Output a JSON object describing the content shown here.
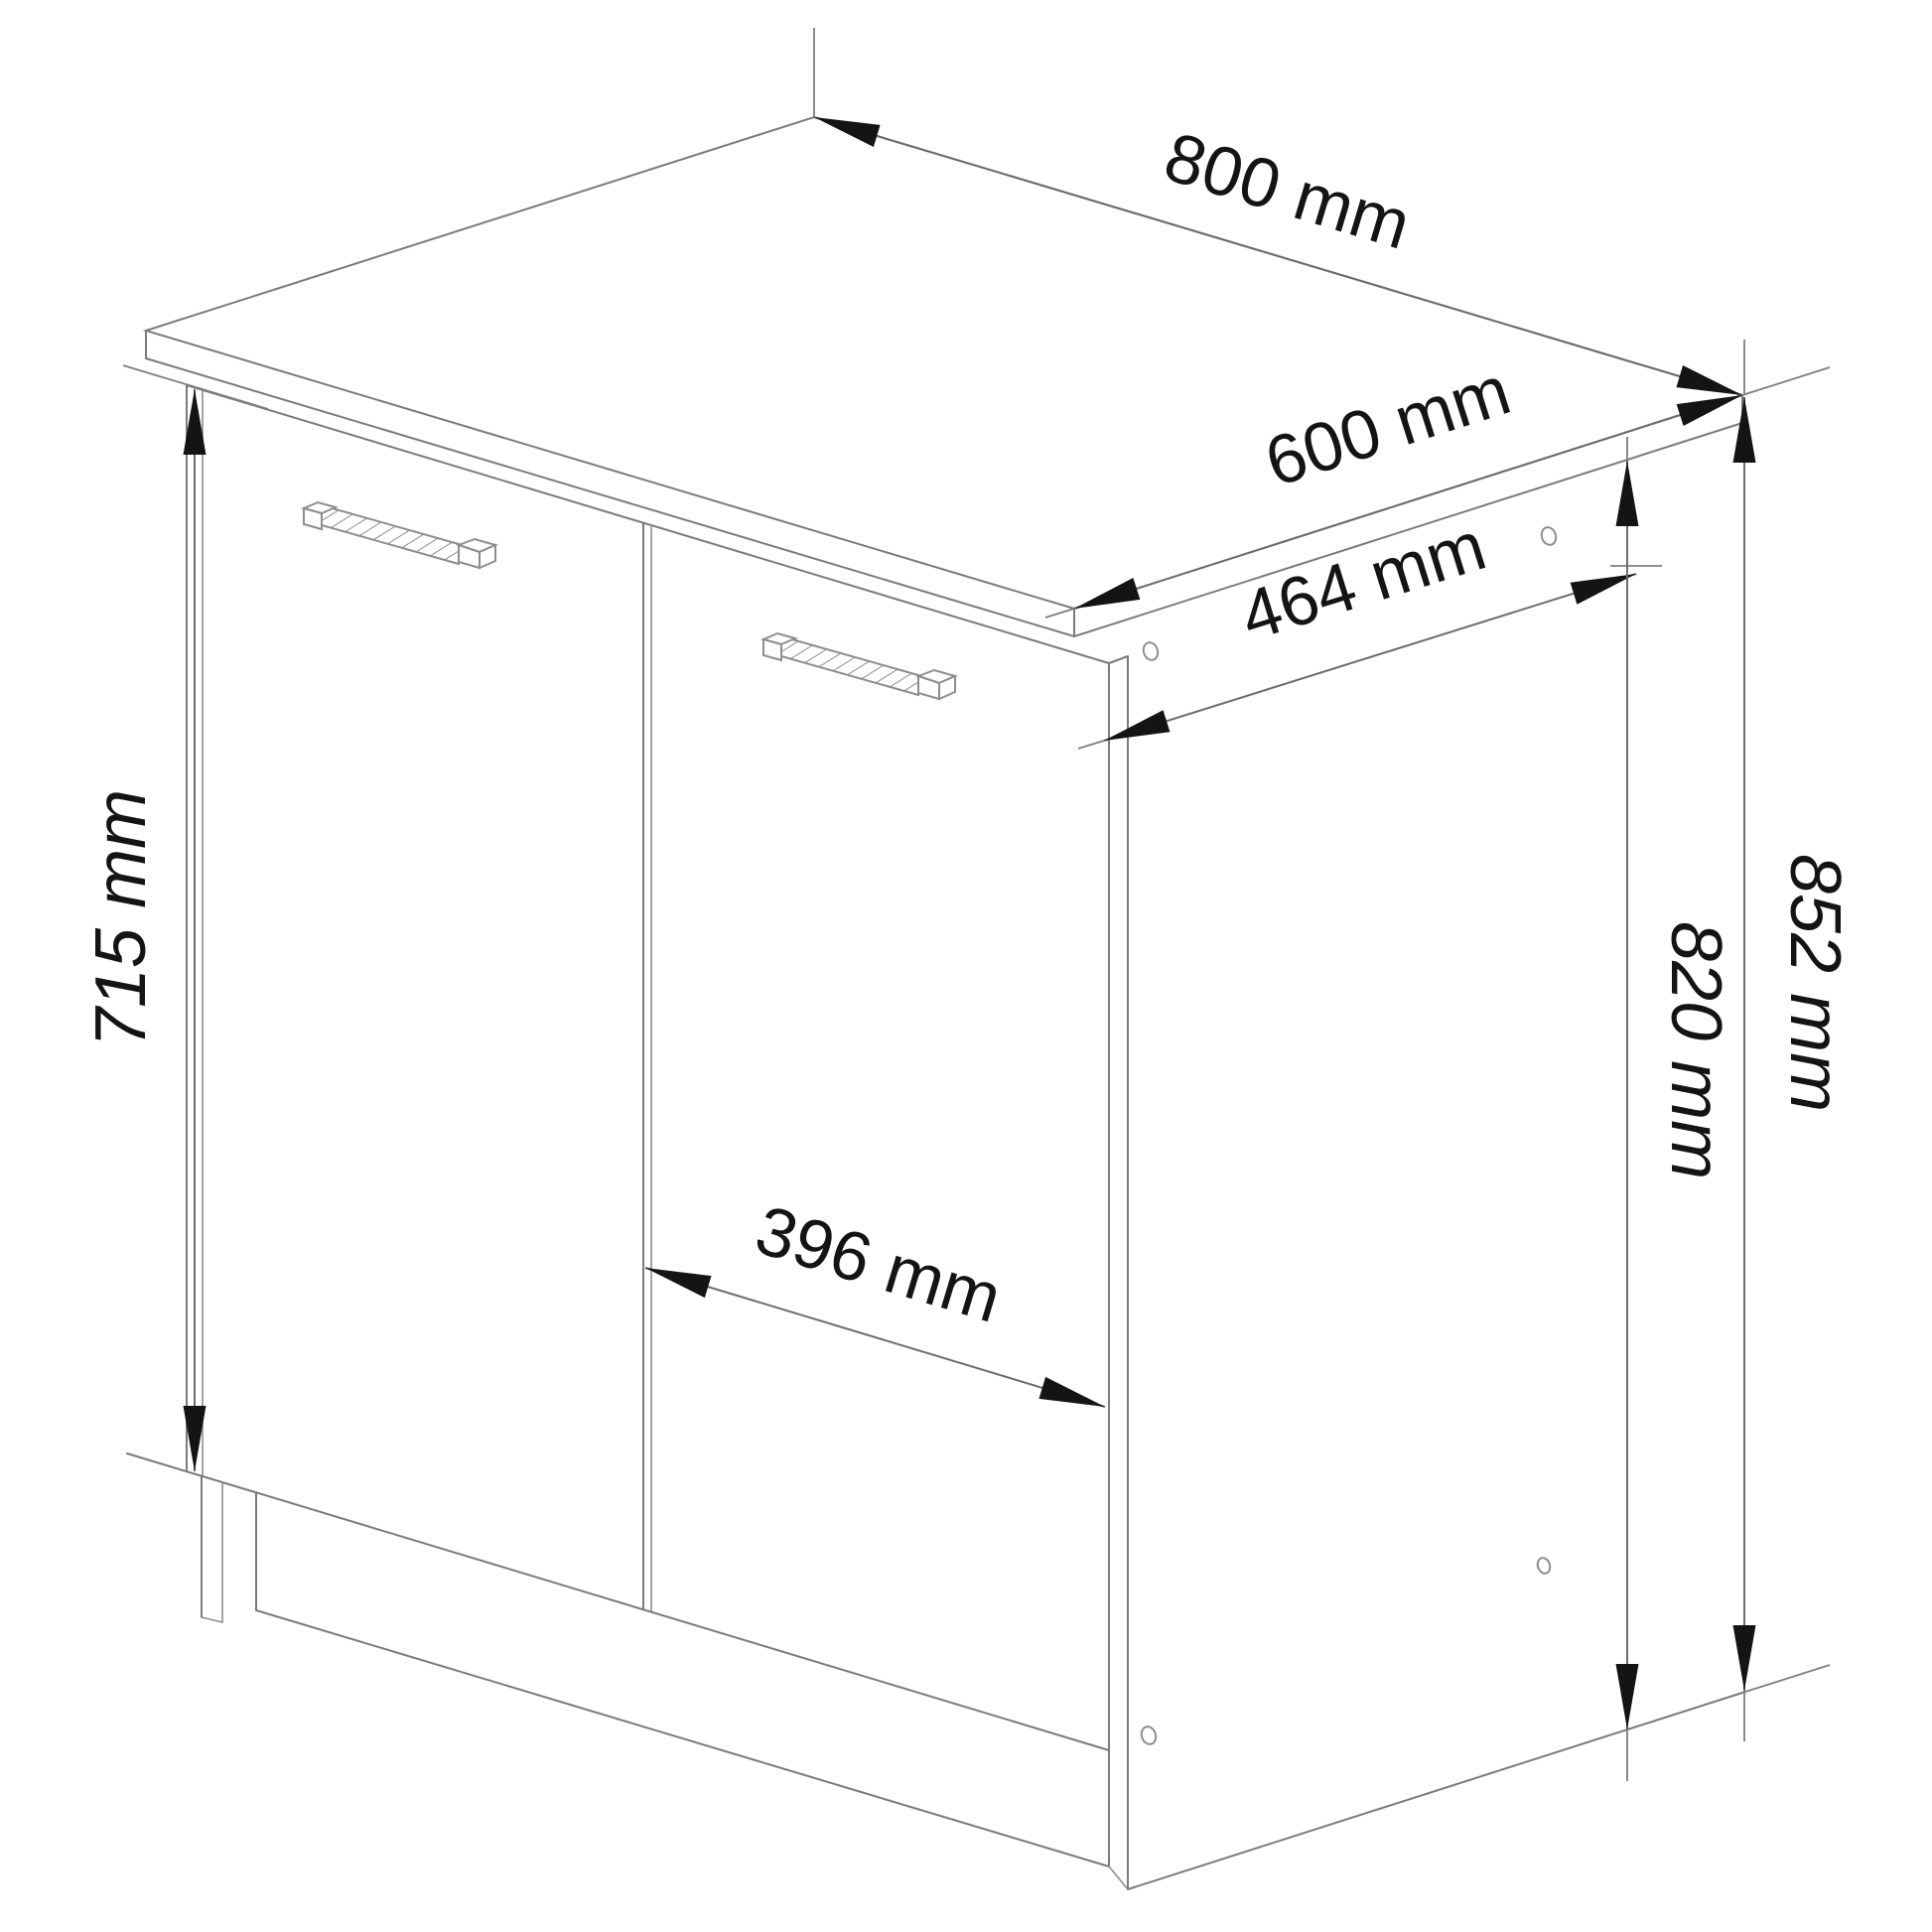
{
  "diagram": {
    "unit": "mm",
    "dimensions": {
      "width": {
        "label": "800 mm",
        "value": 800,
        "unit": "mm",
        "orientation": "top-width"
      },
      "depth": {
        "label": "600 mm",
        "value": 600,
        "unit": "mm",
        "orientation": "top-depth"
      },
      "inner_depth": {
        "label": "464 mm",
        "value": 464,
        "unit": "mm",
        "orientation": "side-depth"
      },
      "door_height": {
        "label": "715 mm",
        "value": 715,
        "unit": "mm",
        "orientation": "vertical-left"
      },
      "door_width": {
        "label": "396 mm",
        "value": 396,
        "unit": "mm",
        "orientation": "front-width"
      },
      "body_height": {
        "label": "820 mm",
        "value": 820,
        "unit": "mm",
        "orientation": "vertical-right"
      },
      "total_height": {
        "label": "852 mm",
        "value": 852,
        "unit": "mm",
        "orientation": "vertical-right-outer"
      }
    },
    "style": {
      "line_color": "#7b7b7b",
      "accent_color": "#141414",
      "background": "#ffffff"
    }
  }
}
